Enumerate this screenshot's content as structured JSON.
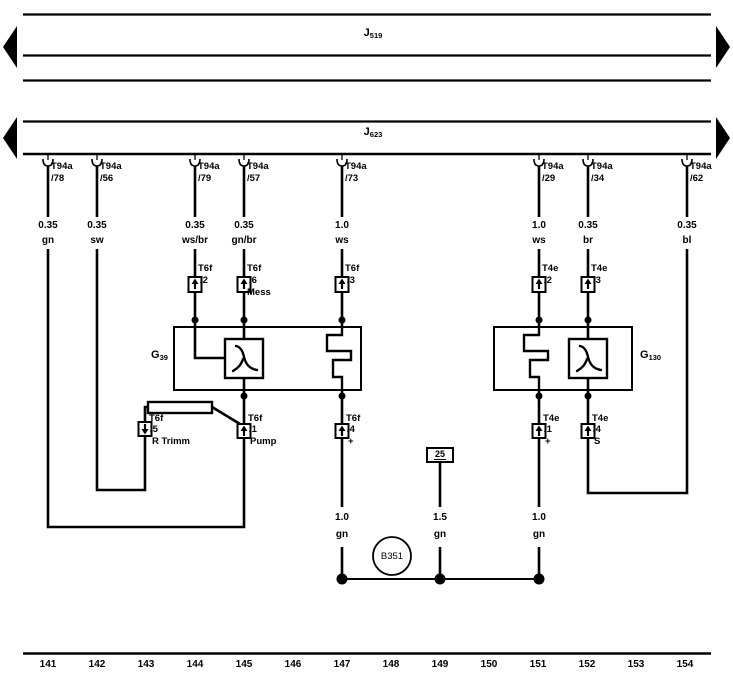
{
  "buses": {
    "j519": {
      "prefix": "J",
      "sub": "519"
    },
    "j623": {
      "prefix": "J",
      "sub": "623"
    }
  },
  "components": {
    "g39": {
      "prefix": "G",
      "sub": "39"
    },
    "g130": {
      "prefix": "G",
      "sub": "130"
    },
    "b351": {
      "label": "B351"
    },
    "ground_25": {
      "label": "25"
    }
  },
  "terminals": [
    {
      "connector": "T94a",
      "pin": "/78"
    },
    {
      "connector": "T94a",
      "pin": "/56"
    },
    {
      "connector": "T94a",
      "pin": "/79"
    },
    {
      "connector": "T94a",
      "pin": "/57"
    },
    {
      "connector": "T94a",
      "pin": "/73"
    },
    {
      "connector": "T94a",
      "pin": "/29"
    },
    {
      "connector": "T94a",
      "pin": "/34"
    },
    {
      "connector": "T94a",
      "pin": "/62"
    }
  ],
  "wire_labels": [
    {
      "gauge": "0.35",
      "color": "gn"
    },
    {
      "gauge": "0.35",
      "color": "sw"
    },
    {
      "gauge": "0.35",
      "color": "ws/br"
    },
    {
      "gauge": "0.35",
      "color": "gn/br"
    },
    {
      "gauge": "1.0",
      "color": "ws"
    },
    {
      "gauge": "1.0",
      "color": "ws"
    },
    {
      "gauge": "0.35",
      "color": "br"
    },
    {
      "gauge": "0.35",
      "color": "bl"
    }
  ],
  "upper_connectors": [
    {
      "name": "T6f",
      "pin": "/2",
      "note": ""
    },
    {
      "name": "T6f",
      "pin": "/6",
      "note": "Mess"
    },
    {
      "name": "T6f",
      "pin": "/3",
      "note": ""
    },
    {
      "name": "T4e",
      "pin": "/2",
      "note": ""
    },
    {
      "name": "T4e",
      "pin": "/3",
      "note": ""
    }
  ],
  "lower_connectors": [
    {
      "name": "T6f",
      "pin": "/5",
      "note": "R Trimm"
    },
    {
      "name": "T6f",
      "pin": "/1",
      "note": "Pump"
    },
    {
      "name": "T6f",
      "pin": "/4",
      "note": "+"
    },
    {
      "name": "T4e",
      "pin": "/1",
      "note": "+"
    },
    {
      "name": "T4e",
      "pin": "/4",
      "note": "S"
    }
  ],
  "lower_wire_labels": [
    {
      "gauge": "1.0",
      "color": "gn"
    },
    {
      "gauge": "1.5",
      "color": "gn"
    },
    {
      "gauge": "1.0",
      "color": "gn"
    }
  ],
  "track_numbers": [
    "141",
    "142",
    "143",
    "144",
    "145",
    "146",
    "147",
    "148",
    "149",
    "150",
    "151",
    "152",
    "153",
    "154"
  ]
}
